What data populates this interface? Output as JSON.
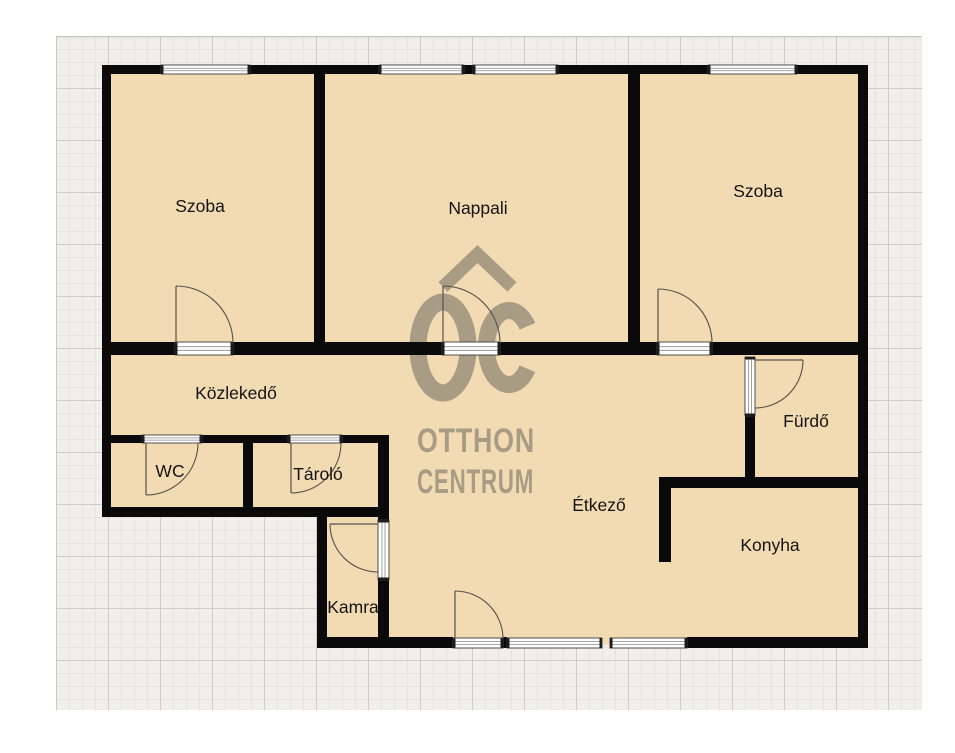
{
  "canvas": {
    "width": 955,
    "height": 753,
    "page_bg": "#ffffff"
  },
  "grid": {
    "x": 56,
    "y": 36,
    "width": 866,
    "height": 674,
    "bg": "#f0efec",
    "major_line": "#cfcdc9",
    "minor_line": "#e6e4e0"
  },
  "colors": {
    "floor": "#f2dbb2",
    "wall": "#0a0a0a",
    "opening_fill": "#ffffff",
    "opening_frame": "#3c3c3c",
    "opening_cap": "#1c1c1c",
    "opening_line": "#8a8a8a",
    "swing": "#56514b",
    "label": "#141414",
    "watermark": "#a89c85"
  },
  "floors": [
    [
      104,
      66,
      762,
      451
    ],
    [
      320,
      515,
      546,
      130
    ]
  ],
  "walls": [
    [
      102,
      65,
      59,
      9
    ],
    [
      250,
      65,
      129,
      9
    ],
    [
      464,
      65,
      9,
      9
    ],
    [
      558,
      65,
      150,
      9
    ],
    [
      797,
      65,
      71,
      9
    ],
    [
      102,
      65,
      9,
      452
    ],
    [
      858,
      65,
      10,
      583
    ],
    [
      314,
      74,
      11,
      268
    ],
    [
      628,
      74,
      12,
      268
    ],
    [
      111,
      342,
      64,
      13
    ],
    [
      233,
      342,
      209,
      13
    ],
    [
      500,
      342,
      157,
      13
    ],
    [
      712,
      342,
      146,
      13
    ],
    [
      102,
      435,
      40,
      8
    ],
    [
      202,
      435,
      86,
      8
    ],
    [
      342,
      435,
      47,
      8
    ],
    [
      243,
      443,
      10,
      74
    ],
    [
      102,
      507,
      287,
      10
    ],
    [
      378,
      435,
      11,
      85
    ],
    [
      378,
      580,
      11,
      68
    ],
    [
      317,
      507,
      10,
      141
    ],
    [
      317,
      637,
      136,
      11
    ],
    [
      503,
      637,
      4,
      11
    ],
    [
      687,
      637,
      181,
      11
    ],
    [
      745,
      416,
      10,
      61
    ],
    [
      659,
      477,
      209,
      11
    ],
    [
      659,
      488,
      12,
      74
    ]
  ],
  "openings": [
    {
      "x": 161,
      "y": 65,
      "w": 89,
      "h": 9,
      "o": "h",
      "t": "window"
    },
    {
      "x": 379,
      "y": 65,
      "w": 85,
      "h": 9,
      "o": "h",
      "t": "window"
    },
    {
      "x": 473,
      "y": 65,
      "w": 85,
      "h": 9,
      "o": "h",
      "t": "window"
    },
    {
      "x": 708,
      "y": 65,
      "w": 89,
      "h": 9,
      "o": "h",
      "t": "window"
    },
    {
      "x": 507,
      "y": 638,
      "w": 95,
      "h": 10,
      "o": "h",
      "t": "window"
    },
    {
      "x": 610,
      "y": 638,
      "w": 77,
      "h": 10,
      "o": "h",
      "t": "window"
    },
    {
      "x": 175,
      "y": 342,
      "w": 58,
      "h": 13,
      "o": "h",
      "t": "door"
    },
    {
      "x": 442,
      "y": 342,
      "w": 58,
      "h": 13,
      "o": "h",
      "t": "door"
    },
    {
      "x": 657,
      "y": 342,
      "w": 55,
      "h": 13,
      "o": "h",
      "t": "door"
    },
    {
      "x": 142,
      "y": 435,
      "w": 60,
      "h": 8,
      "o": "h",
      "t": "door"
    },
    {
      "x": 288,
      "y": 435,
      "w": 54,
      "h": 8,
      "o": "h",
      "t": "door"
    },
    {
      "x": 453,
      "y": 638,
      "w": 50,
      "h": 10,
      "o": "h",
      "t": "door"
    },
    {
      "x": 745,
      "y": 357,
      "w": 10,
      "h": 59,
      "o": "v",
      "t": "door"
    },
    {
      "x": 378,
      "y": 520,
      "w": 11,
      "h": 60,
      "o": "v",
      "t": "door"
    }
  ],
  "swings": [
    {
      "leaf": "M176,343 L176,286",
      "arc": "M176,286 A57,57 0 0 1 233,343"
    },
    {
      "leaf": "M443,343 L443,286",
      "arc": "M443,286 A57,57 0 0 1 500,343"
    },
    {
      "leaf": "M658,343 L658,289",
      "arc": "M658,289 A54,54 0 0 1 712,343"
    },
    {
      "leaf": "M146,443 L146,495",
      "arc": "M146,495 A52,52 0 0 0 198,443"
    },
    {
      "leaf": "M291,443 L291,493",
      "arc": "M291,493 A50,50 0 0 0 341,443"
    },
    {
      "leaf": "M378,524 L330,524",
      "arc": "M330,524 A48,48 0 0 0 378,572"
    },
    {
      "leaf": "M755,360 L803,360",
      "arc": "M803,360 A48,48 0 0 1 755,408"
    },
    {
      "leaf": "M455,639 L455,591",
      "arc": "M455,591 A48,48 0 0 1 503,639"
    }
  ],
  "rooms": [
    {
      "label": "Szoba",
      "x": 200,
      "y": 206
    },
    {
      "label": "Nappali",
      "x": 478,
      "y": 208
    },
    {
      "label": "Szoba",
      "x": 758,
      "y": 191
    },
    {
      "label": "Közlekedő",
      "x": 236,
      "y": 393
    },
    {
      "label": "WC",
      "x": 170,
      "y": 471
    },
    {
      "label": "Tároló",
      "x": 318,
      "y": 474
    },
    {
      "label": "Fürdő",
      "x": 806,
      "y": 421
    },
    {
      "label": "Étkező",
      "x": 599,
      "y": 505
    },
    {
      "label": "Konyha",
      "x": 770,
      "y": 545
    },
    {
      "label": "Kamra",
      "x": 353,
      "y": 607
    }
  ],
  "watermark": {
    "line1": "OTTHON",
    "line2": "CENTRUM",
    "chevron": "M443,287 L477.5,254 L512,287",
    "chevron_width": 13,
    "o": {
      "cx": 443,
      "cy": 347.5,
      "rx": 25,
      "ry": 45.5,
      "sw": 17
    },
    "c_path": "M527.4,326.3 A22.5,37 0 1 0 527.4,368.7",
    "c_sw": 17,
    "text_x": 417,
    "line1_y": 452,
    "line2_y": 493,
    "line1_len": 118,
    "line2_len": 117
  }
}
